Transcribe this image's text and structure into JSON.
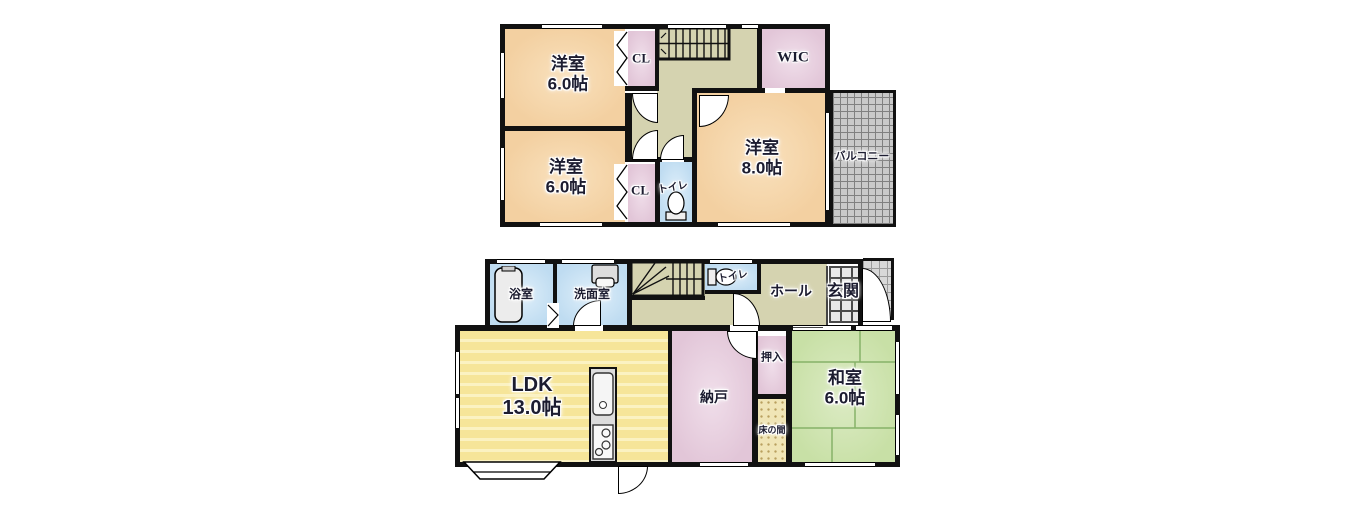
{
  "colors": {
    "wall": "#111111",
    "western_room_tan": "#F3D0A1",
    "closet_pink": "#E2C6D8",
    "hall_olive": "#D5D3B0",
    "water_area_blue": "#BFDCF1",
    "ldk_yellow": "#F6E599",
    "tatami_green": "#C8E0A6",
    "tokonoma_beige": "#F0E5B6",
    "balcony_gray": "#C9C9C9"
  },
  "floor2": {
    "room1": {
      "name": "洋室",
      "area": "6.0帖"
    },
    "room2": {
      "name": "洋室",
      "area": "6.0帖"
    },
    "room3": {
      "name": "洋室",
      "area": "8.0帖"
    },
    "closet1": {
      "name": "CL"
    },
    "closet2": {
      "name": "CL"
    },
    "wic": {
      "name": "WIC"
    },
    "toilet": {
      "name": "トイレ"
    },
    "balcony": {
      "name": "バルコニー"
    }
  },
  "floor1": {
    "bath": {
      "name": "浴室"
    },
    "washroom": {
      "name": "洗面室"
    },
    "toilet": {
      "name": "トイレ"
    },
    "hall": {
      "name": "ホール"
    },
    "entrance": {
      "name": "玄関"
    },
    "ldk": {
      "name": "LDK",
      "area": "13.0帖"
    },
    "storage": {
      "name": "納戸"
    },
    "oshiire": {
      "name": "押入"
    },
    "tokonoma": {
      "name": "床の間"
    },
    "japanese_room": {
      "name": "和室",
      "area": "6.0帖"
    }
  }
}
